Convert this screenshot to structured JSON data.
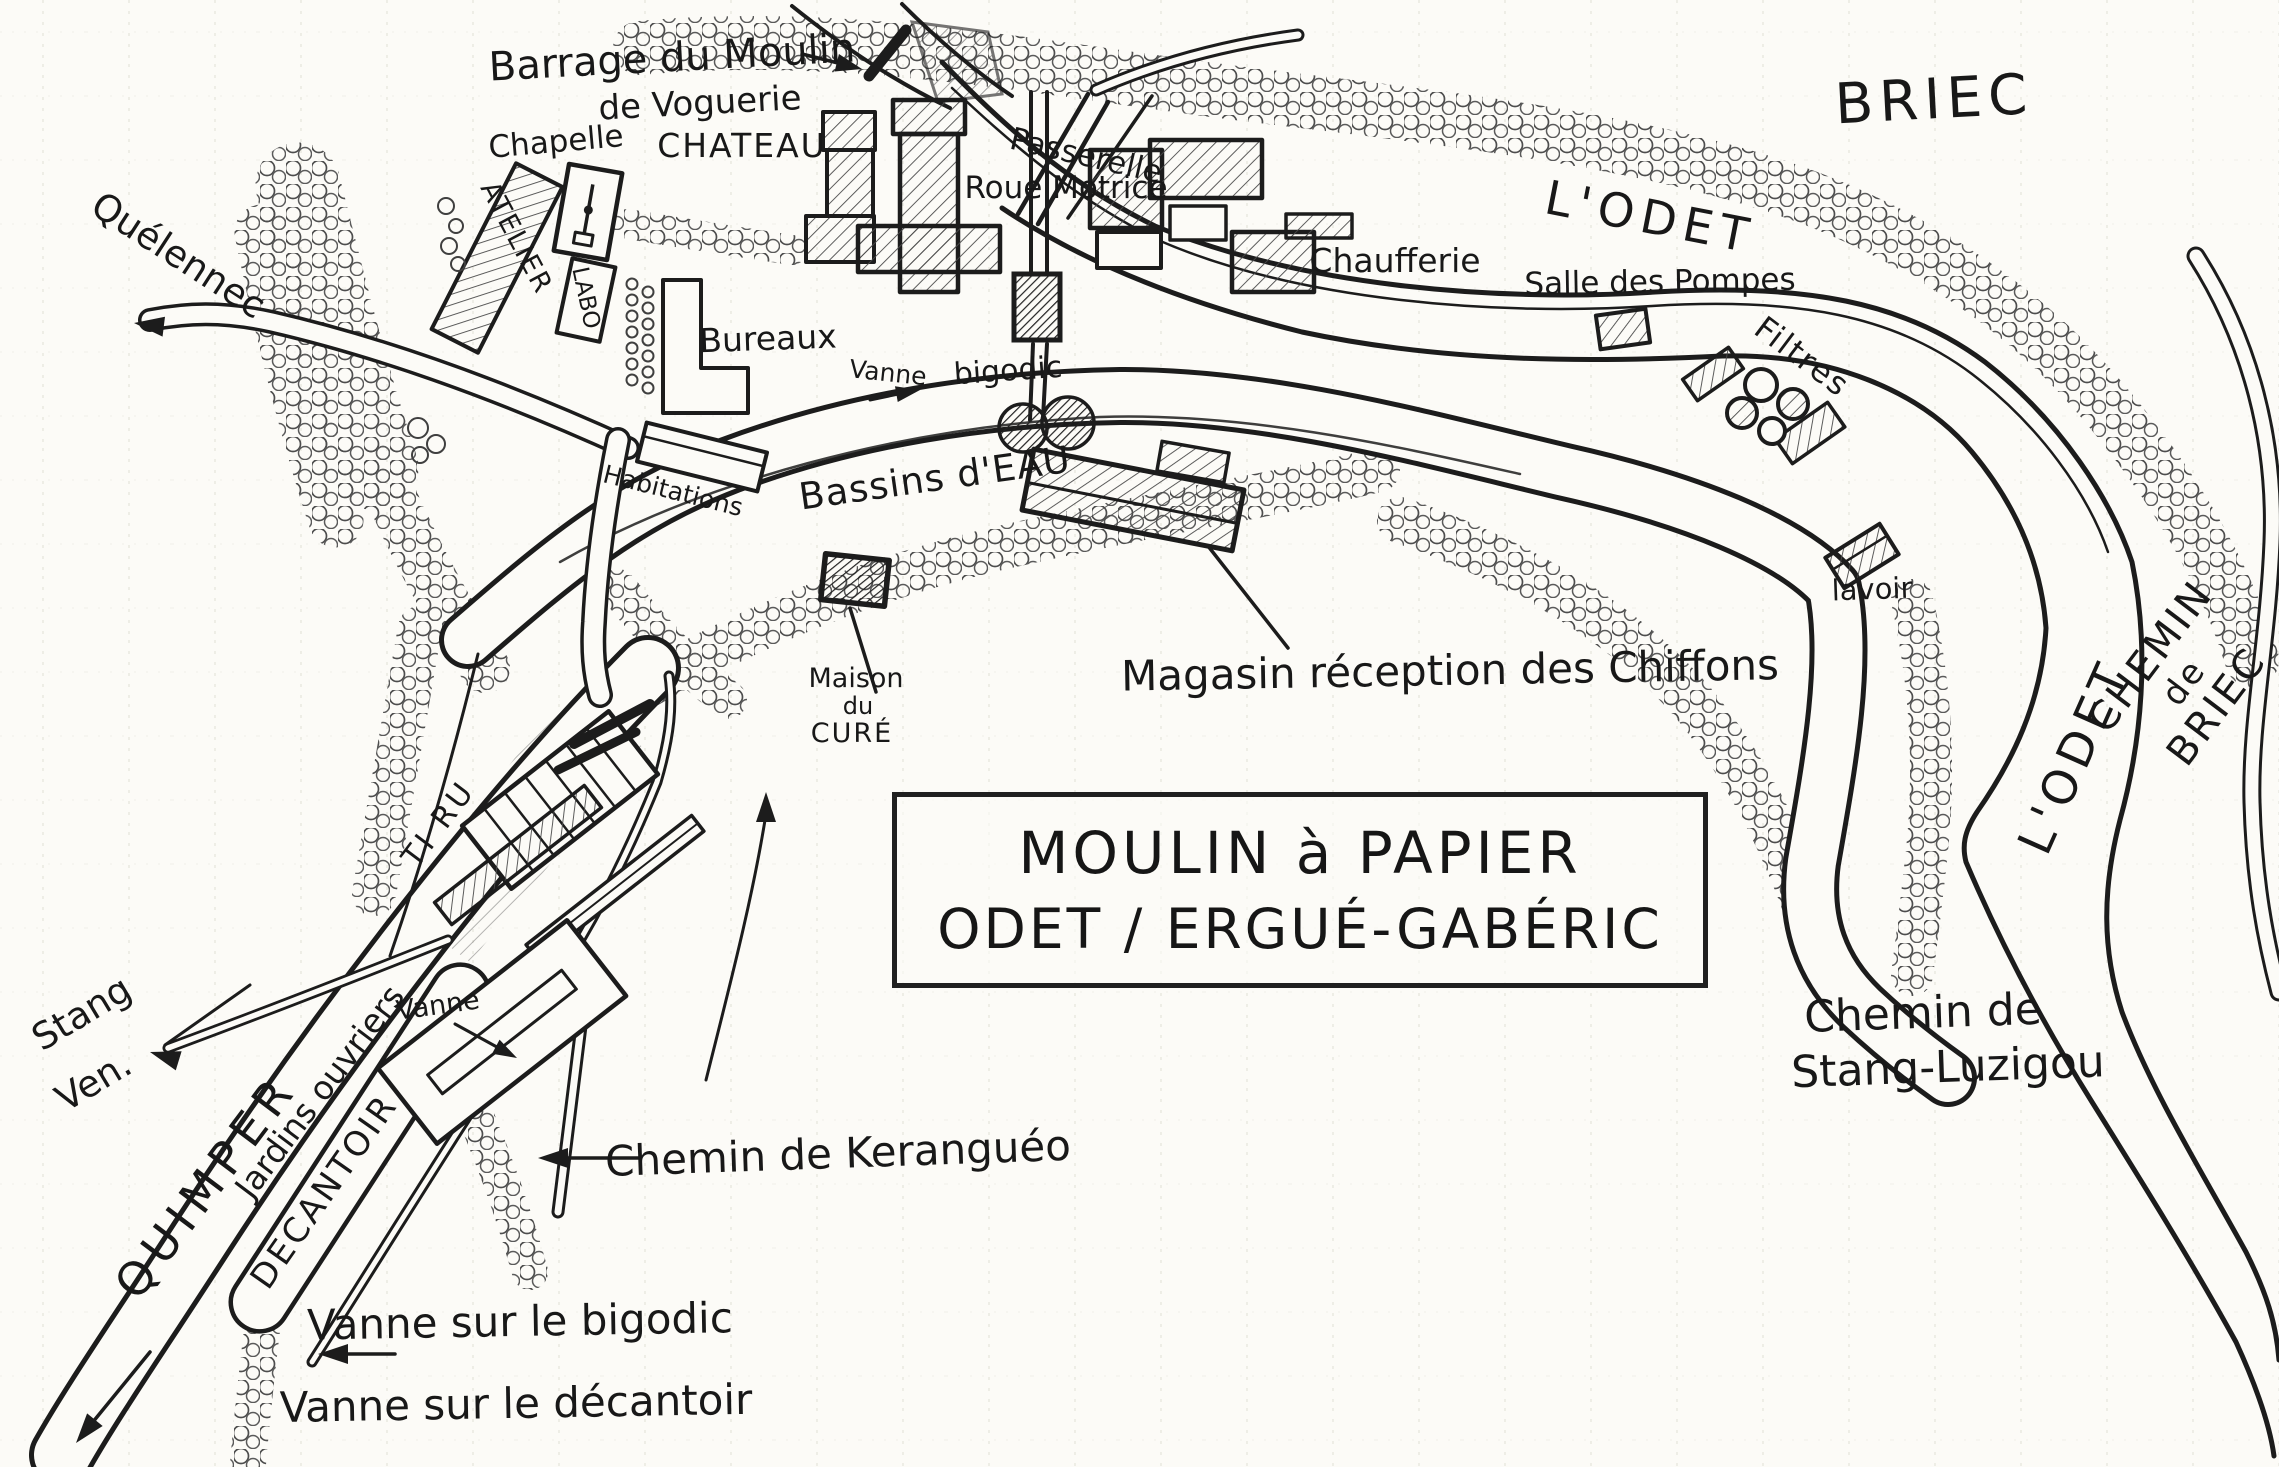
{
  "title": {
    "line1": "MOULIN à PAPIER",
    "line2": "ODET / ERGUÉ-GABÉRIC"
  },
  "labels": {
    "barrage1": "Barrage du Moulin",
    "barrage2": "de Voguerie",
    "chapelle": "Chapelle",
    "chateau": "CHATEAU",
    "atelier": "ATELIER",
    "labo": "LABO",
    "passerelle": "Passerelle",
    "roue_motrice": "Roue Motrice",
    "briec": "BRIEC",
    "odet_top": "L'ODET",
    "chaufferie": "Chaufferie",
    "salle_des_pompes": "Salle des Pompes",
    "filtres": "Filtres",
    "bureaux": "Bureaux",
    "vanne_usine": "Vanne",
    "bigodic": "bigodic",
    "habitations": "Habitations",
    "bassins_eau": "Bassins d'EAU",
    "maison1": "Maison",
    "maison2": "du",
    "maison3": "CURÉ",
    "magasin": "Magasin réception des Chiffons",
    "lavoir": "lavoir",
    "quelennec": "Quélennec",
    "stang1": "Stang",
    "stang2": "Ven.",
    "quimper": "QUIMPER",
    "jardins_ouvriers": "Jardins ouvriers",
    "decantoir": "DECANTOIR",
    "ti_ru": "TI RU",
    "vanne_gauche": "Vanne",
    "chemin_keranguo": "Chemin de Keranguéo",
    "vanne_sur_bigodic": "Vanne sur le bigodic",
    "vanne_sur_decantoir": "Vanne sur le décantoir",
    "chemin_briec1": "CHEMIN",
    "chemin_briec2": "de",
    "chemin_briec3": "BRIEC",
    "odet_right": "L'ODET",
    "stang_luzigou1": "Chemin de",
    "stang_luzigou2": "Stang-Luzigou"
  },
  "colors": {
    "ink": "#1c1c1c",
    "paper": "#fcfbf7",
    "hatch": "#4a4a4a",
    "grid": "#e9e7df"
  }
}
